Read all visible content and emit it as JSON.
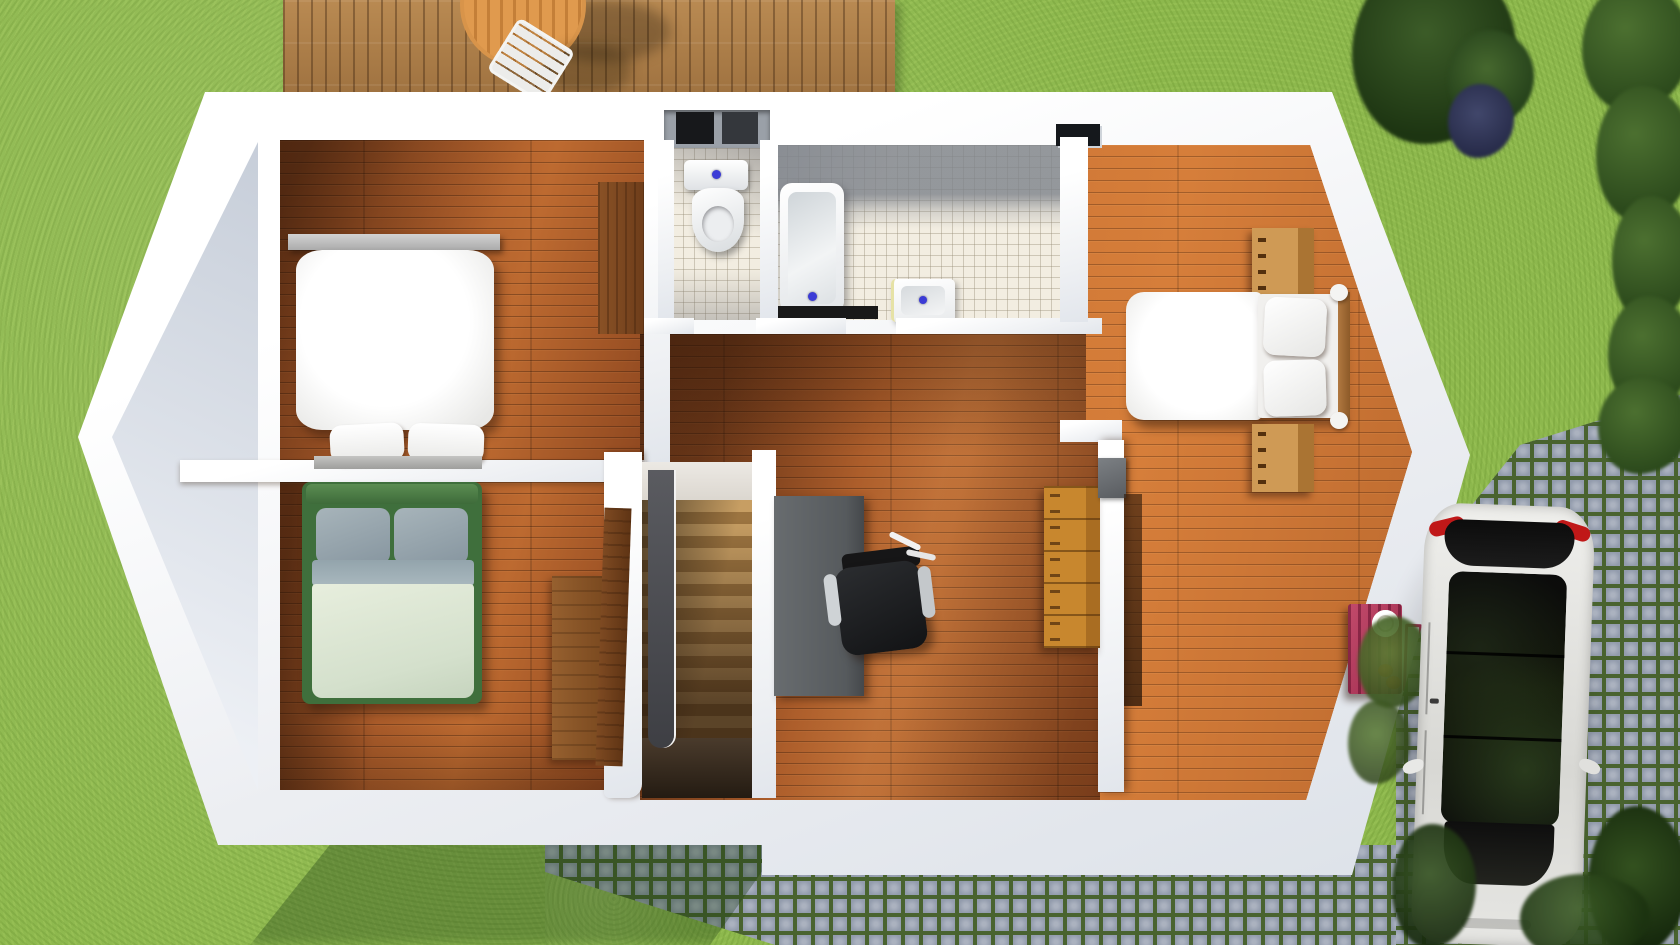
{
  "scene": {
    "title": "3D top-down floor plan render, upper storey of a house",
    "view": "top-down",
    "environment": "lawn, wooden deck, cobblestone path, driveway with parked car, hedges"
  },
  "palette": {
    "grass": "#8db84d",
    "deck_wood": "#a87a47",
    "floor_wood": "#9c5227",
    "floor_wood_light": "#b06128",
    "wall_white": "#f1f2f5",
    "tile": "#f2ede1",
    "cobble_stone": "#939cad",
    "cobble_joint": "#49632f",
    "bed_green": "#4a7d46",
    "dresser_red": "#b23b5e",
    "drain_blue": "#3b3bd6",
    "car_body": "#e5e5e2"
  },
  "rooms": [
    {
      "name": "Bedroom top-left",
      "floor": "wood",
      "furniture": [
        "double bed with white duvet",
        "two white pillows",
        "grey headboard shelf",
        "grey foot bench",
        "wooden wardrobe door"
      ]
    },
    {
      "name": "Bedroom bottom-left",
      "floor": "wood",
      "furniture": [
        "double bed with green frame",
        "two grey-blue pillows",
        "pale sage duvet",
        "wooden wardrobe",
        "open wooden door"
      ]
    },
    {
      "name": "WC",
      "floor": "tile",
      "furniture": [
        "toilet with cistern",
        "wall closet with dark sliding doors"
      ]
    },
    {
      "name": "Bathroom",
      "floor": "tile",
      "furniture": [
        "bathtub",
        "square washbasin",
        "dark floor mat"
      ]
    },
    {
      "name": "Landing hallway",
      "floor": "wood",
      "furniture": [
        "staircase going down",
        "dark grey railing",
        "grey desk",
        "black office chair",
        "wooden chest of drawers",
        "grey wall shelf"
      ]
    },
    {
      "name": "Bedroom right",
      "floor": "wood",
      "furniture": [
        "double bed with white duvet",
        "two stacked pillows",
        "wooden headboard",
        "two wooden nightstands",
        "red dresser with plate and shoes",
        "leaning mirror",
        "open dark door"
      ]
    }
  ],
  "exterior": {
    "deck": {
      "name": "wooden terrace deck",
      "furniture": [
        "round slatted table",
        "white slatted chair"
      ]
    },
    "car": {
      "name": "white hatchback car",
      "color": "white",
      "details": [
        "dark panoramic roof glass",
        "red taillights",
        "side mirrors"
      ],
      "position": "cobblestone driveway bottom right"
    },
    "paths": [
      {
        "name": "cobblestone path bottom"
      },
      {
        "name": "cobblestone driveway right"
      }
    ],
    "vegetation": [
      {
        "name": "hedge right edge"
      },
      {
        "name": "trees top right"
      },
      {
        "name": "dark purple shrubs"
      },
      {
        "name": "bushes beside car"
      },
      {
        "name": "tree canopy bottom right"
      }
    ],
    "lawn": {
      "name": "green lawn"
    }
  }
}
